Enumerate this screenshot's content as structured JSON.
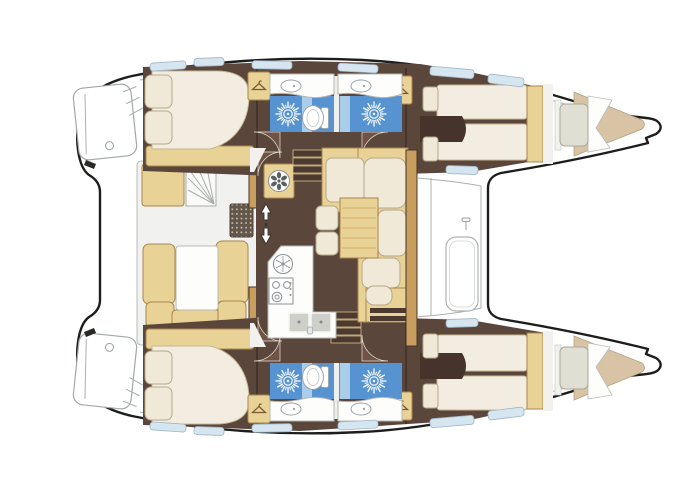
{
  "diagram": {
    "type": "boat-floor-plan",
    "vessel": "sailing catamaran layout, top view, bow to the right",
    "hulls": 2,
    "cabins": 4,
    "heads": 4,
    "rooms": [
      {
        "id": "port-transom",
        "label": "Port transom swim platform with steps"
      },
      {
        "id": "starboard-transom",
        "label": "Starboard transom swim platform with steps"
      },
      {
        "id": "aft-cockpit",
        "label": "Aft cockpit with U-shaped bench seating, table, helm steps and deck grate"
      },
      {
        "id": "salon",
        "label": "Salon with L-shaped settee, table and stools"
      },
      {
        "id": "galley",
        "label": "Galley with round hotplate, stove and twin sinks"
      },
      {
        "id": "nav-station",
        "label": "Navigation station with seat and instrument panel"
      },
      {
        "id": "port-aft-cabin",
        "label": "Port aft double cabin with pillows"
      },
      {
        "id": "port-aft-head",
        "label": "Port aft head: shower, toilet, washbasin"
      },
      {
        "id": "port-forward-head",
        "label": "Port forward head: shower, toilet, washbasin"
      },
      {
        "id": "port-forward-cabin",
        "label": "Port forward cabin with twin berths"
      },
      {
        "id": "port-bow-berth",
        "label": "Port bow storage / crew berth"
      },
      {
        "id": "starboard-aft-cabin",
        "label": "Starboard aft double cabin with pillows"
      },
      {
        "id": "starboard-aft-head",
        "label": "Starboard aft head: shower, toilet, washbasin"
      },
      {
        "id": "starboard-forward-head",
        "label": "Starboard forward head: shower, toilet, washbasin"
      },
      {
        "id": "starboard-forward-cabin",
        "label": "Starboard forward cabin with twin berths"
      },
      {
        "id": "starboard-bow-berth",
        "label": "Starboard bow storage / crew berth"
      },
      {
        "id": "foredeck",
        "label": "Foredeck with hatch between salon and crossbeam"
      }
    ],
    "icons": [
      "hanger-icon",
      "shower-sunburst-icon",
      "toilet-icon",
      "washbasin-icon",
      "stove-icon",
      "hotplate-icon",
      "fan-hatch-icon",
      "sink-icon",
      "companionway-arrows-icon",
      "stairs-icon",
      "deck-grate-icon"
    ]
  },
  "palette": {
    "outline": "#1d1d1b",
    "deck_line": "#a9b0ac",
    "deck_fill": "#f1f1ef",
    "floor": "#5b463c",
    "floor_dark": "#46342c",
    "door_arc": "#6f5344",
    "wood": "#e9d295",
    "wood_dark": "#c89e5f",
    "wood_border": "#a8854e",
    "cushion": "#f0e9d7",
    "cushion_border": "#b6a98b",
    "mattress": "#f2ede0",
    "mattress_border": "#c4b795",
    "bath_blue": "#5793d1",
    "bath_blue_light": "#aacdeb",
    "porcelain": "#ffffff",
    "porcelain_border": "#9aa4ad",
    "window": "#d6e6f0",
    "window_border": "#9fb4c4",
    "bow_mattress": "#d8c3a4",
    "bow_mattress_border": "#b5a284",
    "grate": "#63564a",
    "grate_dot": "#cdc1ab",
    "white": "#ffffff",
    "steps": "#4c392f",
    "steps_edge": "#d9c18c"
  }
}
